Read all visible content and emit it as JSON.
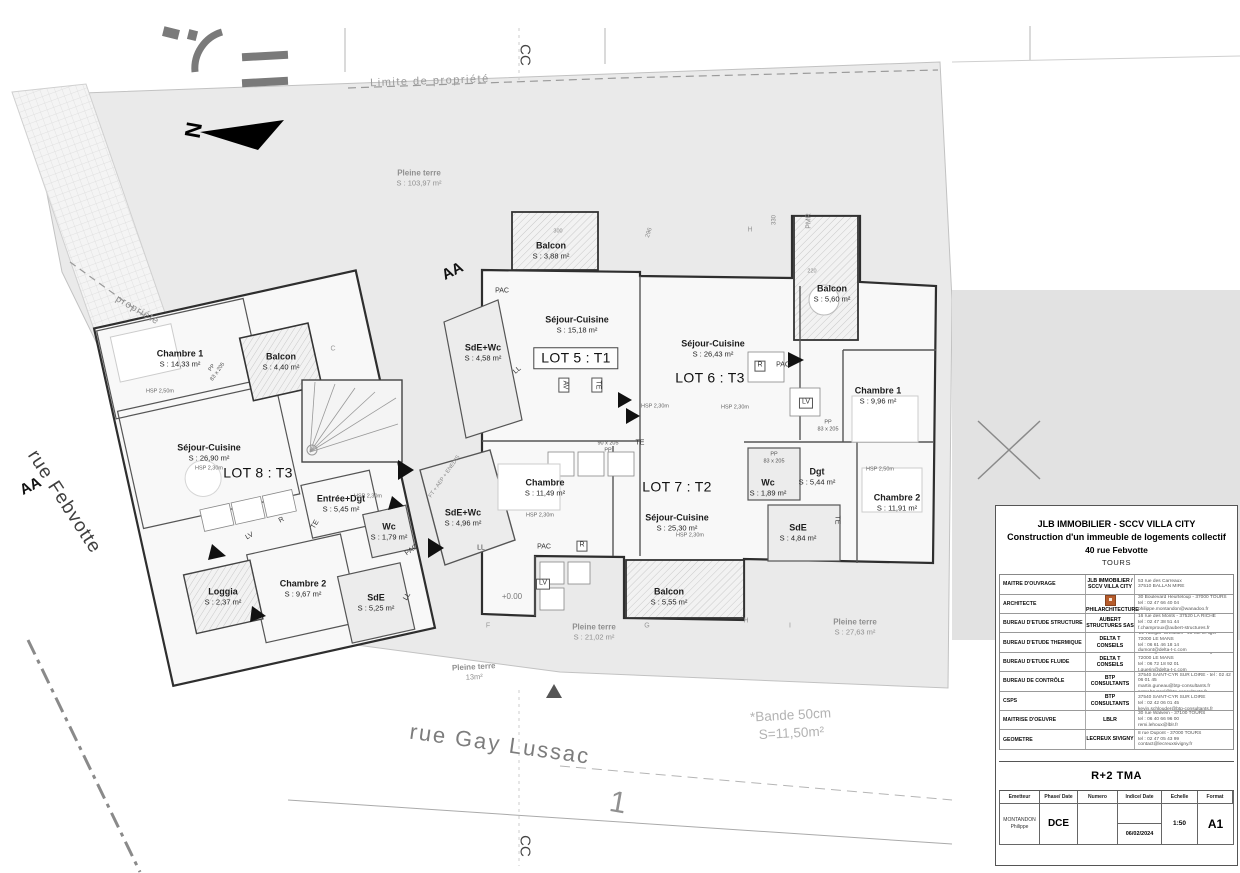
{
  "site": {
    "streets": {
      "febvotte": "rue Febvotte",
      "gay_lussac": "rue Gay Lussac"
    },
    "marks": {
      "aa": "AA",
      "cc": "CC",
      "north": "N"
    },
    "labels": {
      "limite": "Limite de propriété",
      "propriete": "propriété",
      "bande1": "*Bande 50cm",
      "bande2": "S=11,50m²",
      "parcel_number": "1",
      "level": "+0.00",
      "utilities": "FT + AEP + ENEDIS",
      "pmr": "PMR"
    },
    "pleine_terre": [
      {
        "name": "Pleine terre",
        "area": "S : 103,97 m²"
      },
      {
        "name": "Pleine terre",
        "area": "S : 21,02 m²"
      },
      {
        "name": "Pleine terre",
        "area": "13m²"
      },
      {
        "name": "Pleine terre",
        "area": "S : 27,63 m²"
      }
    ],
    "grid": {
      "c": "C",
      "f": "F",
      "g": "G",
      "h": "H",
      "i": "I"
    },
    "dims": {
      "d296": "296",
      "d330": "330",
      "d220": "220",
      "d300": "300"
    }
  },
  "notes": {
    "hsp250": "HSP 2,50m",
    "hsp230": "HSP 2,30m",
    "pp": "PP",
    "pp83": "83 x 205",
    "pp90": "90 x 205"
  },
  "equipment": {
    "pac": "PAC",
    "ll": "LL",
    "lv": "LV",
    "r": "R",
    "te": "TE",
    "av": "AV"
  },
  "lots": [
    {
      "label": "LOT 5 : T1",
      "rooms": [
        {
          "name": "Balcon",
          "area": "S : 3,88 m²"
        },
        {
          "name": "Séjour-Cuisine",
          "area": "S : 15,18 m²"
        },
        {
          "name": "SdE+Wc",
          "area": "S : 4,58 m²"
        }
      ]
    },
    {
      "label": "LOT 6 : T3",
      "rooms": [
        {
          "name": "Séjour-Cuisine",
          "area": "S : 26,43 m²"
        },
        {
          "name": "Balcon",
          "area": "S : 5,60 m²"
        },
        {
          "name": "Chambre 1",
          "area": "S : 9,96 m²"
        },
        {
          "name": "Dgt",
          "area": "S : 5,44 m²"
        },
        {
          "name": "Wc",
          "area": "S : 1,89 m²"
        },
        {
          "name": "SdE",
          "area": "S : 4,84 m²"
        },
        {
          "name": "Chambre 2",
          "area": "S : 11,91 m²"
        }
      ]
    },
    {
      "label": "LOT 7 : T2",
      "rooms": [
        {
          "name": "Chambre",
          "area": "S : 11,49 m²"
        },
        {
          "name": "SdE+Wc",
          "area": "S : 4,96 m²"
        },
        {
          "name": "Séjour-Cuisine",
          "area": "S : 25,30 m²"
        },
        {
          "name": "Balcon",
          "area": "S : 5,55 m²"
        }
      ]
    },
    {
      "label": "LOT 8 : T3",
      "rooms": [
        {
          "name": "Chambre 1",
          "area": "S : 14,33 m²"
        },
        {
          "name": "Balcon",
          "area": "S : 4,40 m²"
        },
        {
          "name": "Séjour-Cuisine",
          "area": "S : 26,90 m²"
        },
        {
          "name": "Entrée+Dgt",
          "area": "S : 5,45 m²"
        },
        {
          "name": "Wc",
          "area": "S : 1,79 m²"
        },
        {
          "name": "Chambre 2",
          "area": "S : 9,67 m²"
        },
        {
          "name": "Loggia",
          "area": "S : 2,37 m²"
        },
        {
          "name": "SdE",
          "area": "S : 5,25 m²"
        }
      ]
    }
  ],
  "title_block": {
    "project": {
      "line1": "JLB IMMOBILIER - SCCV VILLA CITY",
      "line2": "Construction d'un immeuble de logements collectif",
      "line3": "40 rue Febvotte",
      "line4": "TOURS"
    },
    "stakeholders": [
      {
        "role": "MAITRE D'OUVRAGE",
        "company": "JLB IMMOBILIER / SCCV VILLA CITY",
        "lines": [
          "53 rue des Carreaux",
          "37510 BALLAN MIRE"
        ]
      },
      {
        "role": "ARCHITECTE",
        "company": "PHILARCHITECTURE",
        "lines": [
          "30 Boulevard Heurteloup - 37000 TOURS",
          "tel : 02 47 66 40 04",
          "philippe.montandon@wanadoo.fr"
        ]
      },
      {
        "role": "BUREAU D'ETUDE STRUCTURE",
        "company": "AUBERT STRUCTURES SAS",
        "lines": [
          "16 rue des Monts - 37520 LA RICHE",
          "tel : 02 47 38 51 44",
          "f.champroux@aubert-structures.fr"
        ]
      },
      {
        "role": "BUREAU D'ETUDE THERMIQUE",
        "company": "DELTA T CONSEILS",
        "lines": [
          "'Le Hangar' Créobois - 40 rue d'Alger - 72000 LE MANS",
          "tel : 06 61 46 18 14",
          "dumont@delta-t-c.com"
        ]
      },
      {
        "role": "BUREAU D'ETUDE FLUIDE",
        "company": "DELTA T CONSEILS",
        "lines": [
          "'Le Hangar' Créobois - 40 rue d'Alger - 72000 LE MANS",
          "tel : 06 72 18 92 01",
          "t.guerin@delta-t-c.com"
        ]
      },
      {
        "role": "BUREAU DE CONTRÔLE",
        "company": "BTP CONSULTANTS",
        "lines": [
          "2 avenue Pierre Gilles de Gennes -",
          "37540 SAINT-CYR SUR LOIRE - tel : 02 42 06 01 45",
          "martin.guneau@btp-consultants.fr",
          "peter.brussel@btp-consultants.fr"
        ]
      },
      {
        "role": "CSPS",
        "company": "BTP CONSULTANTS",
        "lines": [
          "2 avenue Pierre Gilles de Gennes -",
          "37540 SAINT-CYR SUR LOIRE",
          "tel : 02 42 06 01 45",
          "kevin.schlouder@btp-consultants.fr"
        ]
      },
      {
        "role": "MAITRISE D'OEUVRE",
        "company": "LBLR",
        "lines": [
          "30 rue Walvein - 37100 TOURS",
          "tel : 06 40 66 96 00",
          "remi.lehoux@lblr.fr"
        ]
      },
      {
        "role": "GEOMETRE",
        "company": "LECREUX SIVIGNY",
        "lines": [
          "8 rue Dupont - 37000 TOURS",
          "tel : 02 47 05 43 99",
          "contact@lecreuxsivigny.fr"
        ]
      }
    ],
    "drawing_title": "R+2 TMA",
    "emission": {
      "headers": [
        "Emetteur",
        "Phase/ Date",
        "Numero",
        "Indice/ Date",
        "Echelle",
        "Format"
      ],
      "emetteur_line1": "MONTANDON",
      "emetteur_line2": "Philippe",
      "phase": "DCE",
      "numero": "",
      "indice_date": "06/02/2024",
      "echelle": "1:50",
      "format": "A1"
    }
  }
}
